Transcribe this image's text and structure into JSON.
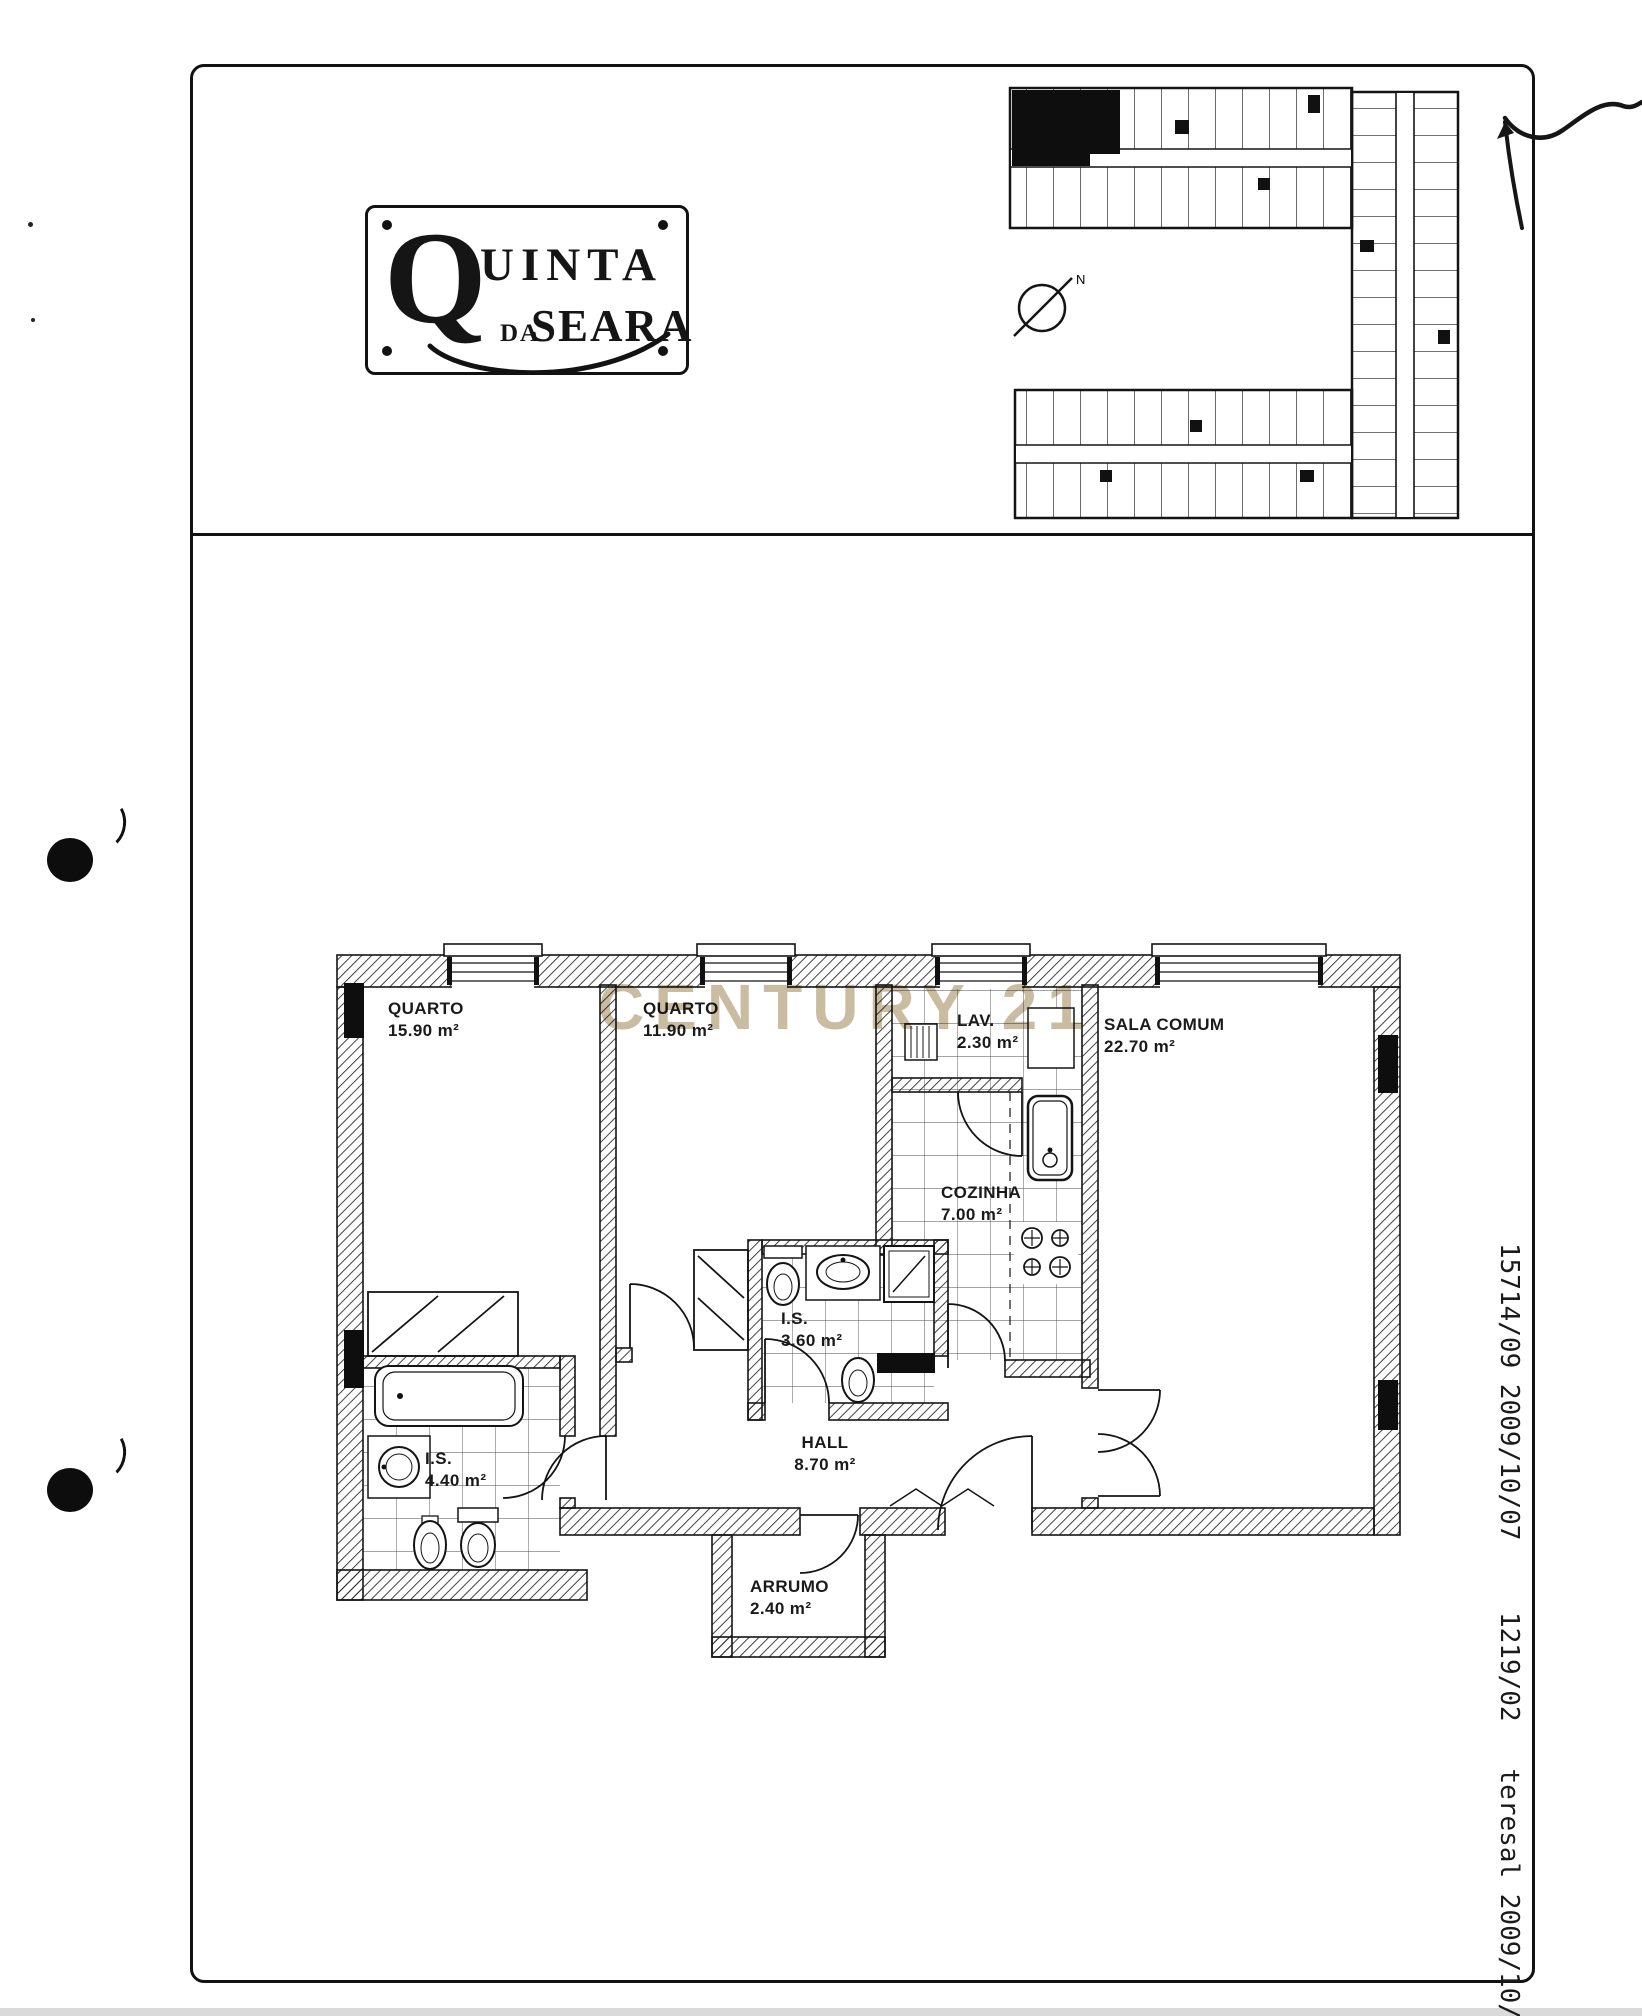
{
  "header": {
    "logo": {
      "initial": "Q",
      "rest": "UINTA",
      "middle": "DA",
      "bottom": "SEARA"
    },
    "key_plan": {
      "compass_label": "N"
    }
  },
  "watermark": {
    "text": "CENTURY 21",
    "color": "#c9bca0"
  },
  "floor_plan": {
    "rooms": [
      {
        "id": "quarto-1",
        "name": "QUARTO",
        "area": "15.90 m²"
      },
      {
        "id": "quarto-2",
        "name": "QUARTO",
        "area": "11.90 m²"
      },
      {
        "id": "lav",
        "name": "LAV.",
        "area": "2.30 m²"
      },
      {
        "id": "sala",
        "name": "SALA COMUM",
        "area": "22.70 m²"
      },
      {
        "id": "cozinha",
        "name": "COZINHA",
        "area": "7.00 m²"
      },
      {
        "id": "is-1",
        "name": "I.S.",
        "area": "3.60 m²"
      },
      {
        "id": "is-2",
        "name": "I.S.",
        "area": "4.40 m²"
      },
      {
        "id": "hall",
        "name": "HALL",
        "area": "8.70 m²"
      },
      {
        "id": "arrumo",
        "name": "ARRUMO",
        "area": "2.40 m²"
      }
    ]
  },
  "margin_notes": {
    "line1": "15714/09 2009/10/07",
    "line2": "1219/02   teresal 2009/10/2"
  }
}
